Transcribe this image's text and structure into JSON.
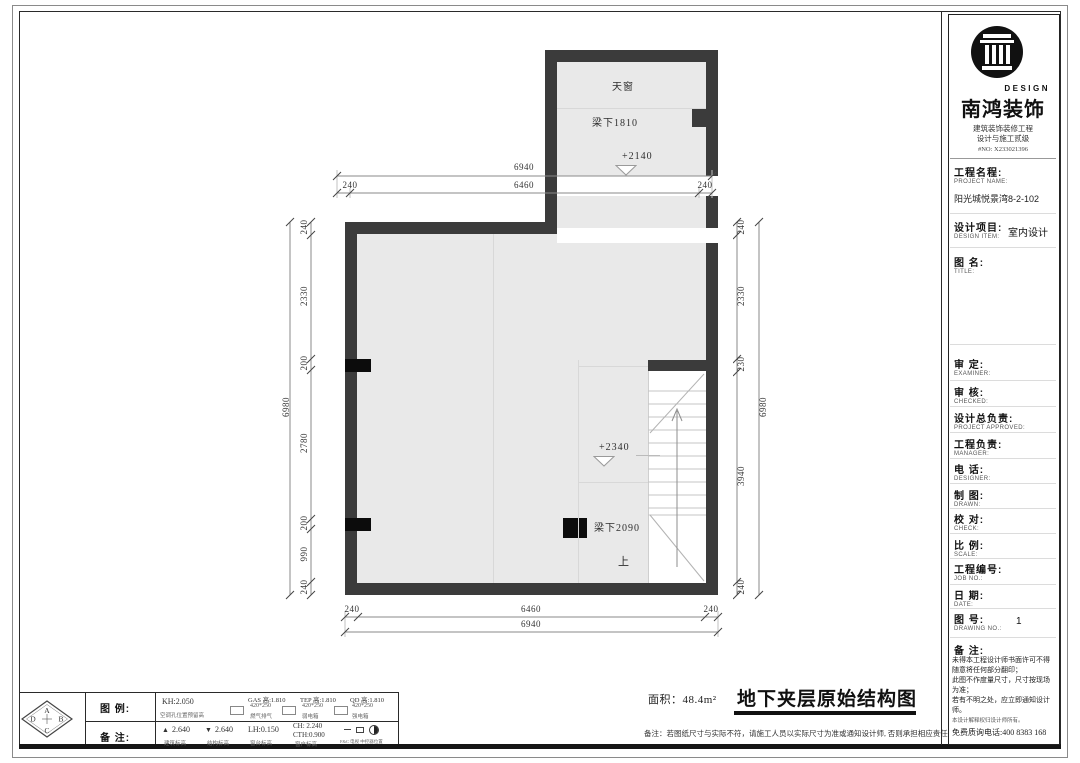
{
  "plan": {
    "labels": {
      "skylight": "天窗",
      "beam_top": "梁下1810",
      "level_top": "+2140",
      "level_mid": "+2340",
      "beam_mid": "梁下2090",
      "up": "上"
    },
    "dims": {
      "top_total": "6940",
      "top_segments": [
        "240",
        "6460",
        "240"
      ],
      "bottom_segments": [
        "240",
        "6460",
        "240"
      ],
      "bottom_total": "6940",
      "left_segments": [
        "240",
        "2330",
        "200",
        "2780",
        "200",
        "990",
        "240"
      ],
      "left_total": "6980",
      "right_segments": [
        "240",
        "2330",
        "230",
        "3940",
        "240"
      ],
      "right_total": "6980"
    }
  },
  "titleblock": {
    "logo": {
      "design": "DESIGN",
      "company": "南鸿装饰",
      "cert_line1": "建筑装饰装修工程",
      "cert_line2": "设计与施工贰级",
      "cert_no": "#NO: X233021396"
    },
    "rows": [
      {
        "label": "工程名程:",
        "sub": "PROJECT NAME:",
        "value": "阳光城悦景湾8-2-102"
      },
      {
        "label": "设计项目:",
        "sub": "DESIGN ITEM:",
        "value": "室内设计"
      },
      {
        "label": "图 名:",
        "sub": "TITLE:",
        "value": ""
      },
      {
        "label": "审 定:",
        "sub": "EXAMINER:",
        "value": ""
      },
      {
        "label": "审 核:",
        "sub": "CHECKED:",
        "value": ""
      },
      {
        "label": "设计总负责:",
        "sub": "PROJECT APPROVED:",
        "value": ""
      },
      {
        "label": "工程负责:",
        "sub": "MANAGER:",
        "value": ""
      },
      {
        "label": "电 话:",
        "sub": "DESIGNER:",
        "value": ""
      },
      {
        "label": "制 图:",
        "sub": "DRAWN:",
        "value": ""
      },
      {
        "label": "校 对:",
        "sub": "CHECK:",
        "value": ""
      },
      {
        "label": "比 例:",
        "sub": "SCALE:",
        "value": ""
      },
      {
        "label": "工程编号:",
        "sub": "JOB NO.:",
        "value": ""
      },
      {
        "label": "日 期:",
        "sub": "DATE:",
        "value": ""
      },
      {
        "label": "图 号:",
        "sub": "DRAWING NO.:",
        "value": "1"
      }
    ],
    "remarks": {
      "label": "备 注:",
      "text": "未得本工程设计师书面许可不得\n随意将任何部分翻印；\n此图不作度量尺寸，尺寸按现场\n为准；\n若有不明之处，应立即通知设计\n师。",
      "fine_print": "本设计解释权归设计师所有。",
      "phone": "免费质询电话:400 8383 168"
    }
  },
  "legend": {
    "compass": {
      "top": "A",
      "right": "B",
      "bottom": "C",
      "left": "D"
    },
    "row1_label": "图 例:",
    "row2_label": "备 注:",
    "row1_items": [
      {
        "main": "KH:2.050",
        "sub": "空调孔位置预留高"
      },
      {
        "main": "GAS 高:1.810",
        "size": "420*250",
        "sub": "燃气排气"
      },
      {
        "main": "TEP 高:1.810",
        "size": "420*250",
        "sub": "弱电箱"
      },
      {
        "main": "QD 高:1.810",
        "size": "420*250",
        "sub": "强电箱"
      }
    ],
    "row2_items": [
      {
        "icon": "▲",
        "main": "2.640",
        "sub": "建筑标高"
      },
      {
        "icon": "▼",
        "main": "2.640",
        "sub": "结构标高"
      },
      {
        "main": "LH:0.150",
        "sub": "窗台标高"
      },
      {
        "main": "CH: 2.240",
        "main2": "CTH:0.900",
        "sub": "窗户标高"
      },
      {
        "sub": "F&C 电视 中控器位置"
      }
    ]
  },
  "footer": {
    "area_label": "面积：48.4m²",
    "title": "地下夹层原始结构图",
    "note": "备注：若图纸尺寸与实际不符，请施工人员以实际尺寸为准或通知设计师, 否则承担相应责任"
  },
  "colors": {
    "wall": "#3b3b3b",
    "room_fill": "#e9e9e9",
    "dim_line": "#8a8a8a"
  }
}
